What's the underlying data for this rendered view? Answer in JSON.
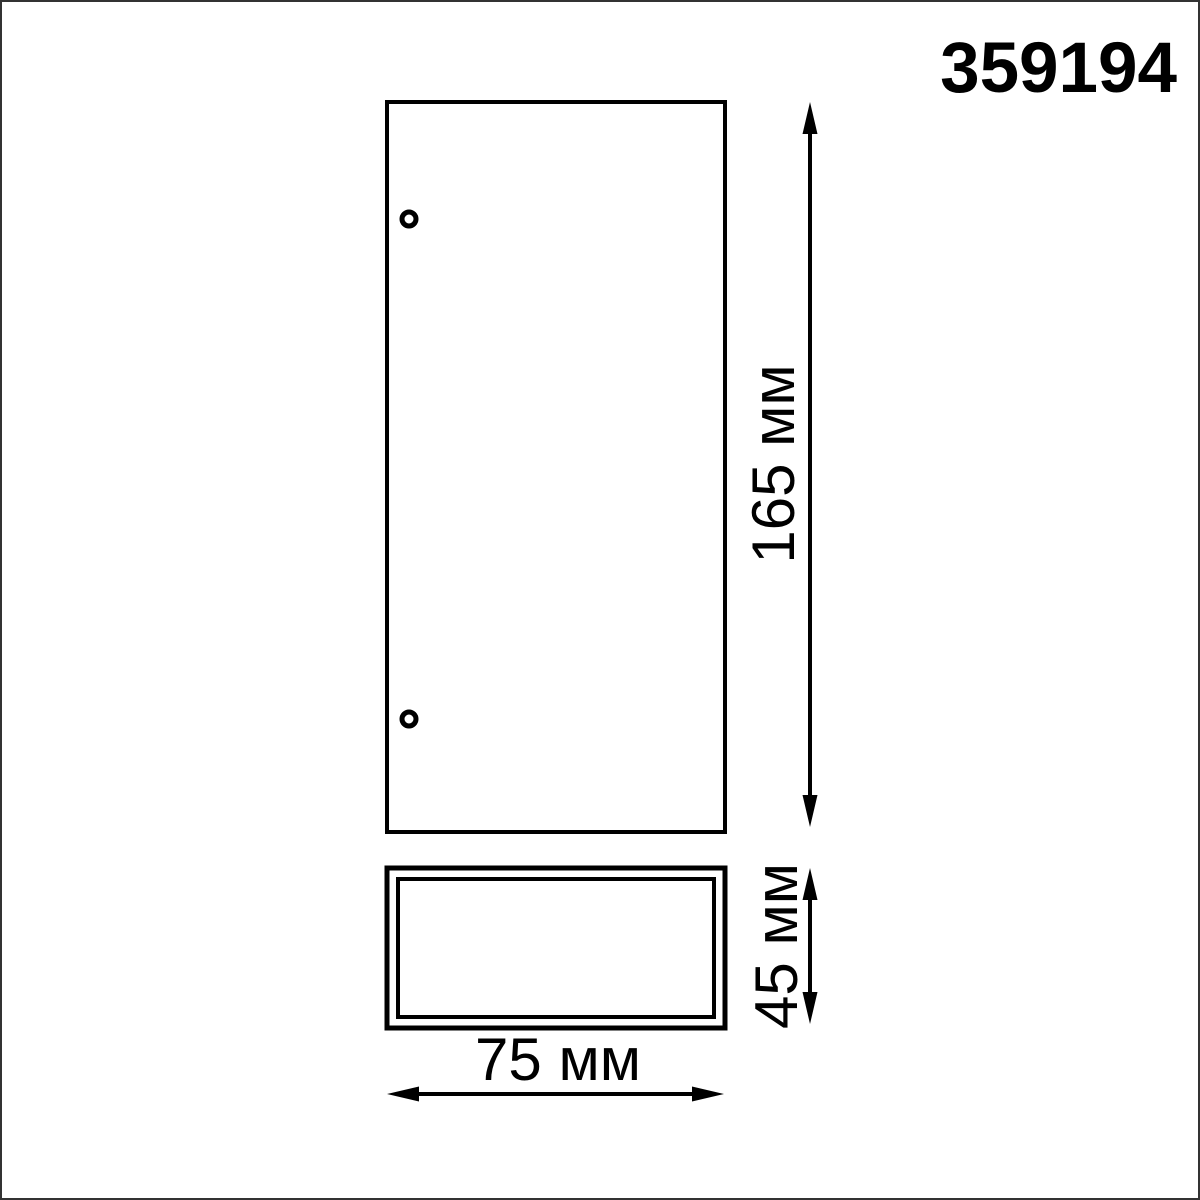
{
  "product_code": "359194",
  "views": {
    "front_view": "front-view-outline",
    "bottom_view": "bottom-view-outline",
    "mounting_holes": 2
  },
  "dimensions": {
    "height_label": "165 мм",
    "depth_label": "45 мм",
    "width_label": "75 мм"
  },
  "colors": {
    "line": "#000000",
    "background": "#ffffff",
    "frame": "#333333"
  }
}
